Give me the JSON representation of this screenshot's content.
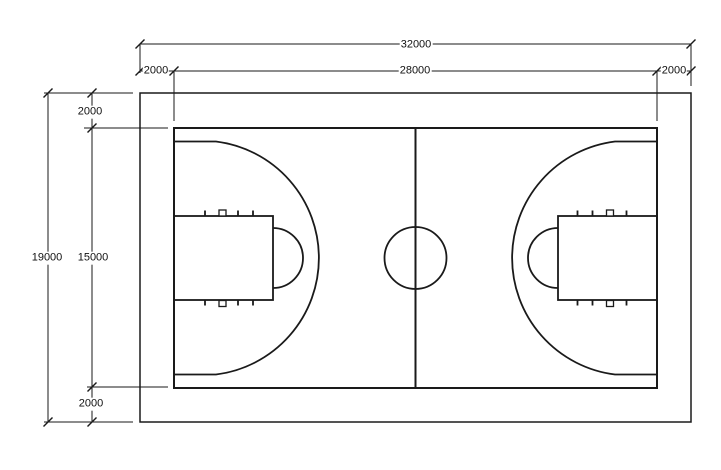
{
  "drawing": {
    "type": "basketball-court-dimension-plan",
    "dimensions": {
      "total_width": "32000",
      "court_width": "28000",
      "margin_left": "2000",
      "margin_right": "2000",
      "total_height": "19000",
      "court_height": "15000",
      "margin_top": "2000",
      "margin_bottom": "2000"
    },
    "colors": {
      "line": "#1a1a1a",
      "background": "#ffffff"
    }
  }
}
